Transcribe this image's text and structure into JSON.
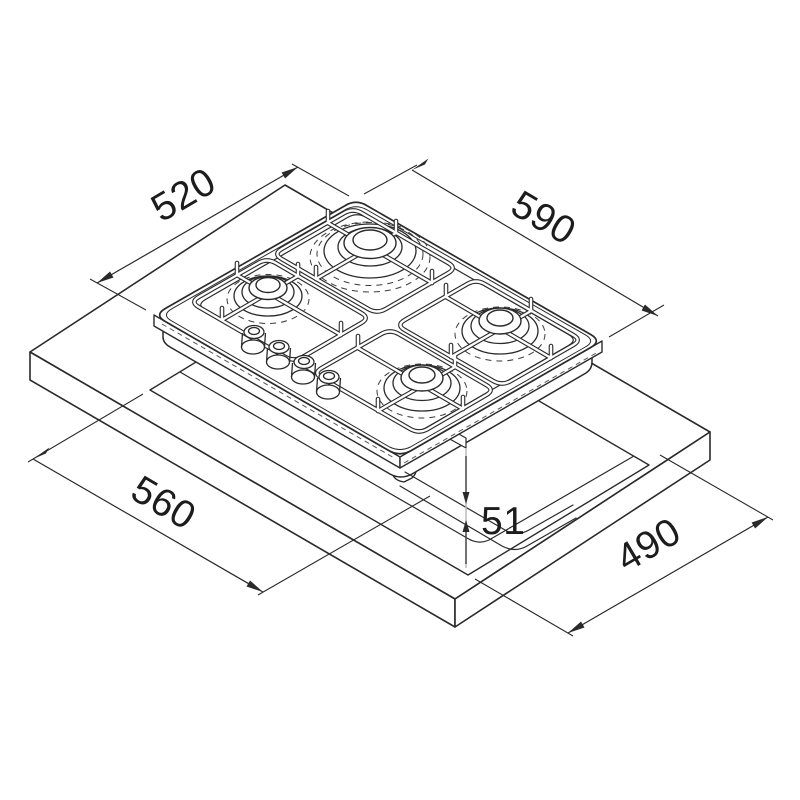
{
  "diagram": {
    "title": "Built-in gas hob installation drawing",
    "product": "4-burner gas hob with worktop cutout",
    "dimensions": {
      "hob_depth_mm": "520",
      "hob_width_mm": "590",
      "cutout_width_mm": "560",
      "hob_below_counter_mm": "51",
      "cutout_depth_mm": "490"
    }
  },
  "colors": {
    "line": "#2a2a2a",
    "thin_line": "#3a3a3a",
    "guide_line": "#b5b5b5",
    "background": "#ffffff",
    "text": "#1c1c1c"
  }
}
